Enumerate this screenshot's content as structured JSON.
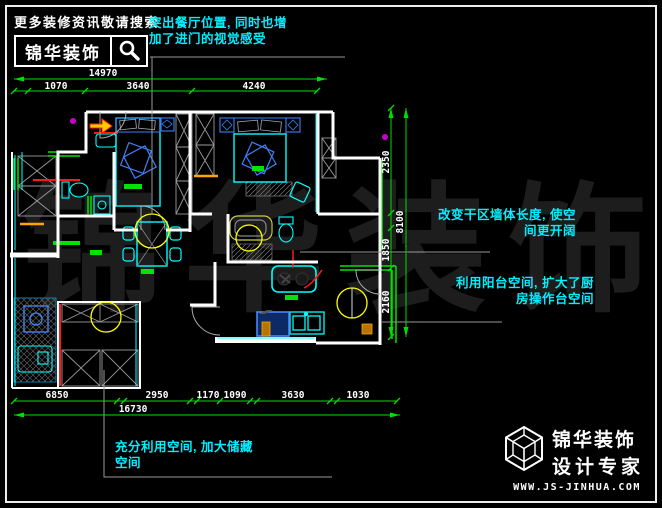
{
  "banner": {
    "tagline": "更多装修资讯敬请搜索",
    "brand": "锦华装饰"
  },
  "annotations": {
    "dining": {
      "line1": "突出餐厅位置, 同时也增",
      "line2": "加了进门的视觉感受"
    },
    "dry_zone": {
      "line1": "改变干区墙体长度, 使空",
      "line2": "间更开阔"
    },
    "balcony_kitchen": {
      "line1": "利用阳台空间, 扩大了厨",
      "line2": "房操作台空间"
    },
    "storage": {
      "line1": "充分利用空间, 加大储藏",
      "line2": "空间"
    }
  },
  "dimensions": {
    "top_total": "14970",
    "top_segments": [
      "1070",
      "3640",
      "4240"
    ],
    "right_total": "8100",
    "right_segments": [
      "2350",
      "1850",
      "2160"
    ],
    "bottom_segments": [
      "6850",
      "2950",
      "1170",
      "1090",
      "3630",
      "1030"
    ],
    "bottom_total": "16730"
  },
  "watermark": "锦华装饰",
  "footer": {
    "brand": "锦华装饰",
    "subtitle": "设计专家",
    "website": "WWW.JS-JINHUA.COM"
  },
  "colors": {
    "annotation": "#00f0ff",
    "dimension_line": "#00dd00",
    "dimension_text": "#ffffff",
    "wall": "#ffffff",
    "furniture_blue": "#3b82f6",
    "furniture_cyan": "#00ffff",
    "light_yellow": "#ffff00",
    "accent_green": "#00e400",
    "accent_red": "#ff1a1a",
    "accent_orange": "#ffa500",
    "watermark": "#1d1d1d"
  }
}
